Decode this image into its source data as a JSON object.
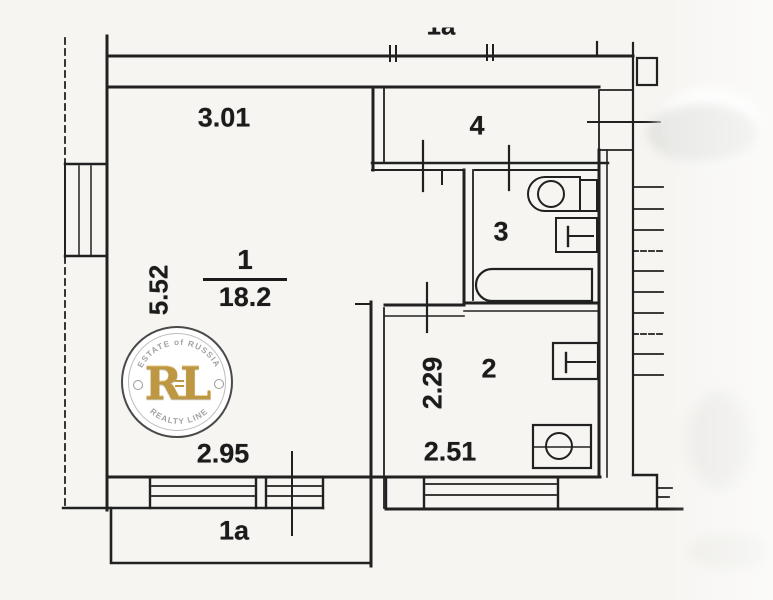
{
  "labels": {
    "top_partial": "1a",
    "dim_top": "3.01",
    "dim_left": "5.52",
    "dim_bottom": "2.95",
    "dim_kitchen_width": "2.29",
    "dim_kitchen_bottom": "2.51",
    "room1_number": "1",
    "room1_area": "18.2",
    "room2_number": "2",
    "room3_number": "3",
    "room4_number": "4",
    "balcony_label": "1a"
  },
  "watermark": {
    "monogram": "RL",
    "arc_top": "ESTATE of RUSSIA",
    "arc_bottom": "REALTY LINE",
    "gold_color": "#BE9742",
    "ring_color": "#4a4a4a",
    "arc_text_color": "#a3a3a3"
  },
  "colors": {
    "line": "#212121",
    "paper": "#f6f5f2",
    "text": "#1b1b1b"
  }
}
